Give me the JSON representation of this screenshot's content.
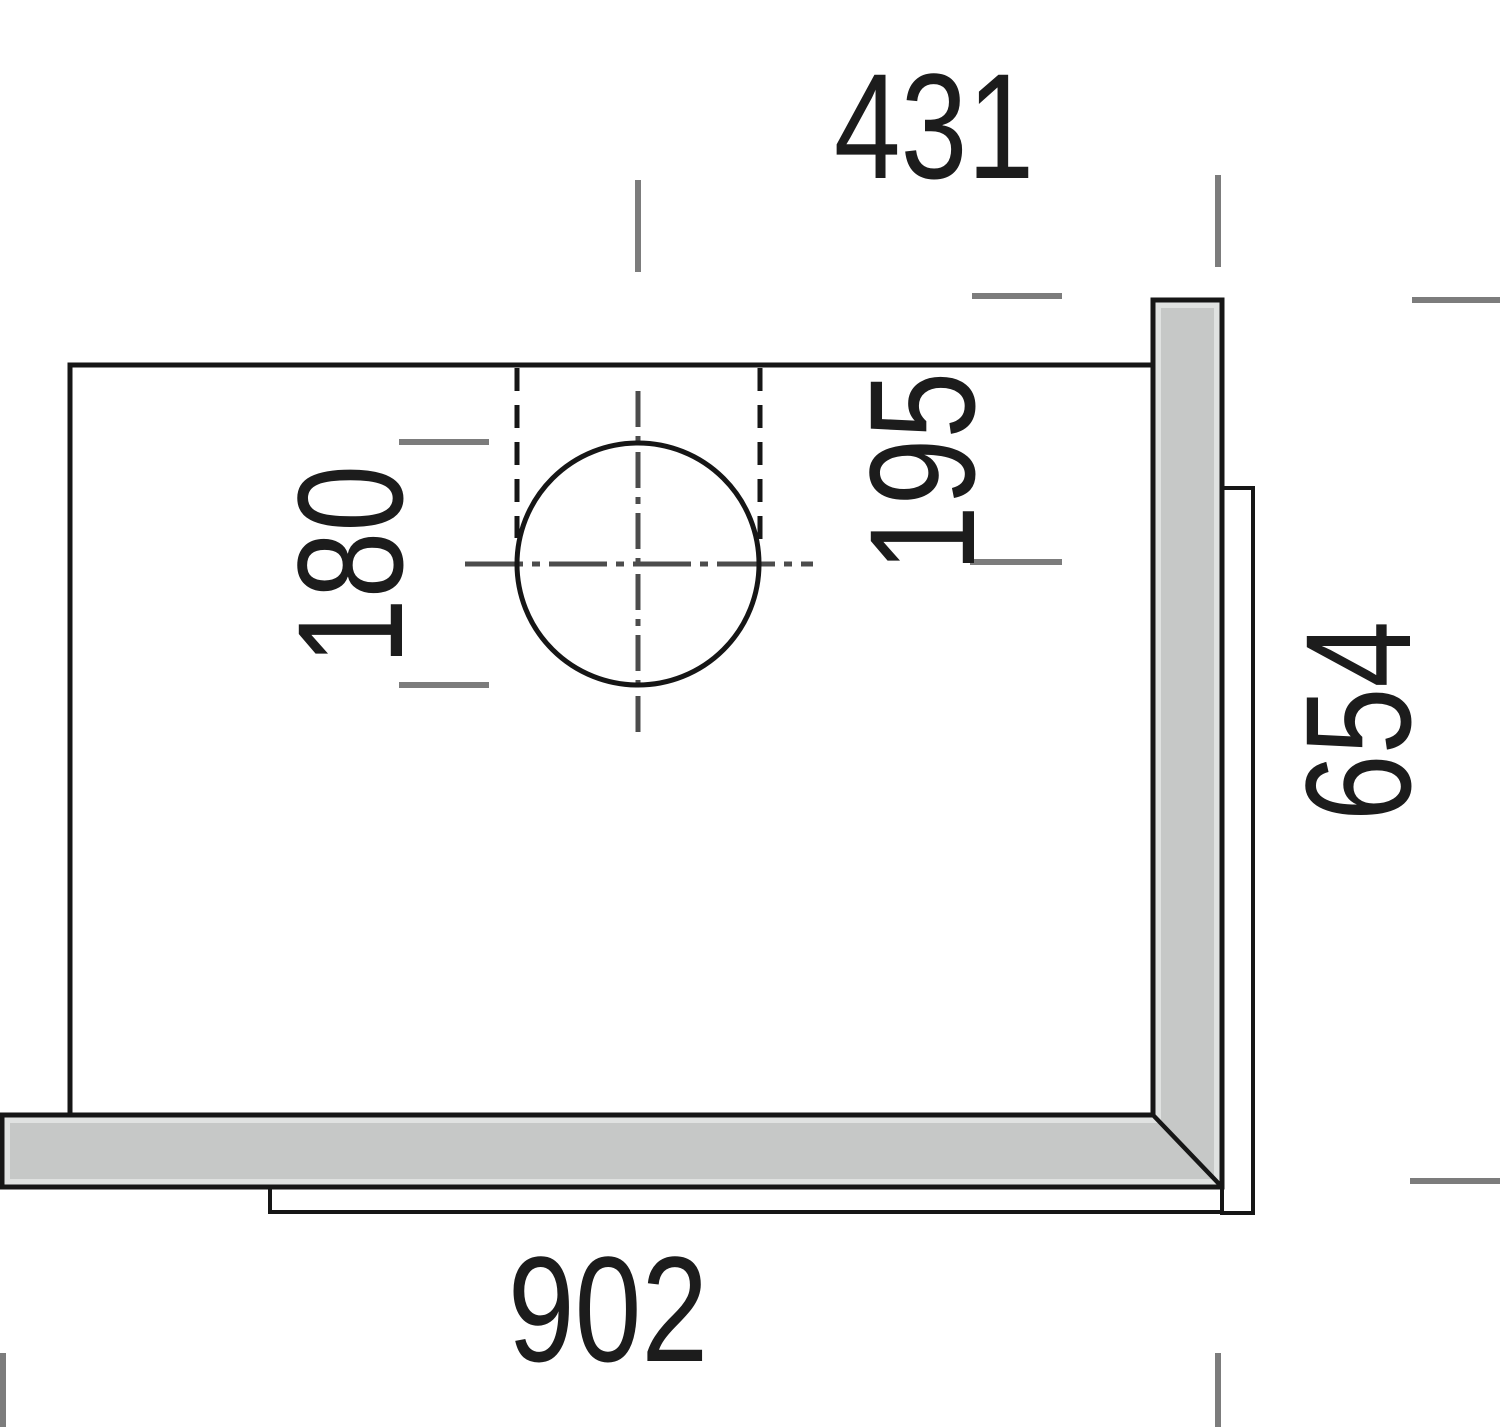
{
  "drawing": {
    "title": "corner-unit-plan-view",
    "dimensions": {
      "top_width": "431",
      "flue_center_offset": "195",
      "flue_diameter": "180",
      "side_depth": "654",
      "bottom_width": "902"
    }
  },
  "colors": {
    "bg": "#ffffff",
    "line": "#161616",
    "text": "#1c1c1c",
    "tick": "#7c7c7c",
    "centerline": "#4c4c4c",
    "wallFill": "#c6c8c7",
    "wallLight": "#e0e2e1"
  }
}
